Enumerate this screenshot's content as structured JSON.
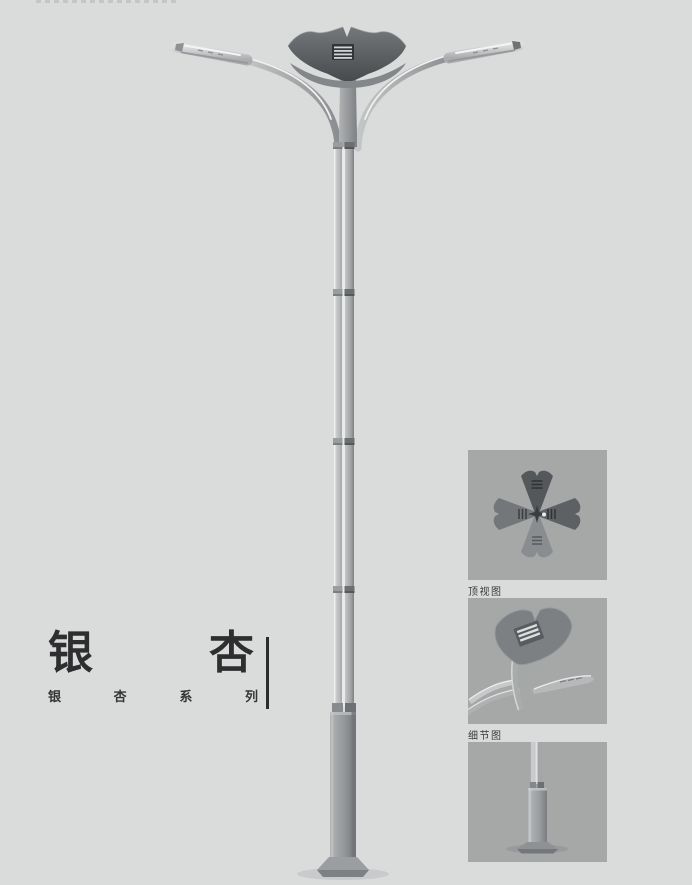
{
  "title_block": {
    "title": "银杏",
    "title_chars": [
      "银",
      "杏"
    ],
    "subtitle": "银杏系列",
    "subtitle_chars": [
      "银",
      "杏",
      "系",
      "列"
    ]
  },
  "detail_panels": [
    {
      "id": "top-view",
      "label": "顶视图"
    },
    {
      "id": "detail-view",
      "label": "细节图"
    },
    {
      "id": "base-view",
      "label": ""
    }
  ],
  "colors": {
    "page_background": "#dadbdb",
    "panel_background": "#a6a7a7",
    "crown_dark": "#54575a",
    "metal_light": "#c9cbcc",
    "metal_mid": "#9fa1a3",
    "metal_dark": "#7c7e80",
    "text": "#2e2e30"
  }
}
